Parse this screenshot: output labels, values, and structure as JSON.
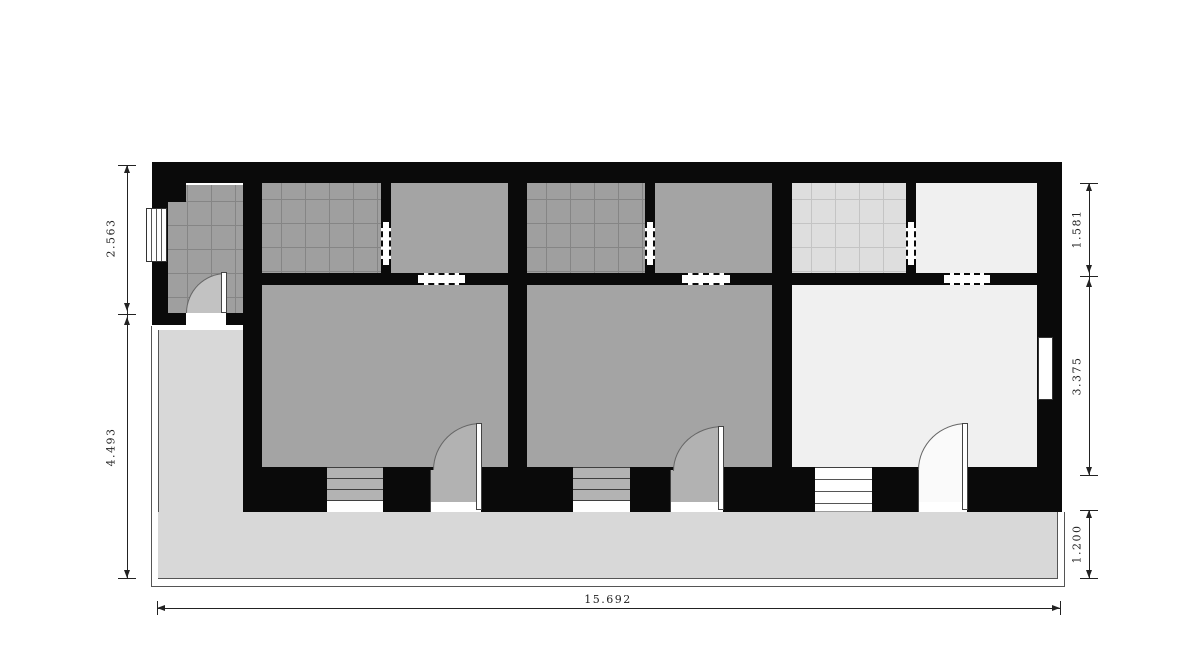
{
  "drawing": {
    "kind": "architectural-floor-plan",
    "units": 3
  },
  "dimensions": {
    "left": [
      "2.563",
      "4.493"
    ],
    "right": [
      "1.581",
      "3.375",
      "1.200"
    ],
    "bottom": [
      "15.692"
    ]
  },
  "rooms": [
    {
      "name": "entry-vestibule",
      "floor": "tiled-gray"
    },
    {
      "name": "unit1-bathroom",
      "floor": "tiled-gray"
    },
    {
      "name": "unit1-back-room",
      "floor": "gray"
    },
    {
      "name": "unit1-main-room",
      "floor": "gray"
    },
    {
      "name": "unit2-bathroom",
      "floor": "tiled-gray"
    },
    {
      "name": "unit2-back-room",
      "floor": "gray"
    },
    {
      "name": "unit2-main-room",
      "floor": "gray"
    },
    {
      "name": "unit3-bathroom",
      "floor": "tiled-light"
    },
    {
      "name": "unit3-back-room",
      "floor": "light"
    },
    {
      "name": "unit3-main-room",
      "floor": "light"
    },
    {
      "name": "terrace",
      "floor": "porch"
    }
  ],
  "features": {
    "swing_doors": 4,
    "windows": 5,
    "dashed_wall_openings": 6
  },
  "colors": {
    "wall": "#0a0a0a",
    "room_gray": "#a4a4a4",
    "tile_gray": "#9f9f9f",
    "room_light": "#f0f0f0",
    "tile_light": "#dedede",
    "porch": "#d8d8d8",
    "dimension_text": "#222222"
  }
}
